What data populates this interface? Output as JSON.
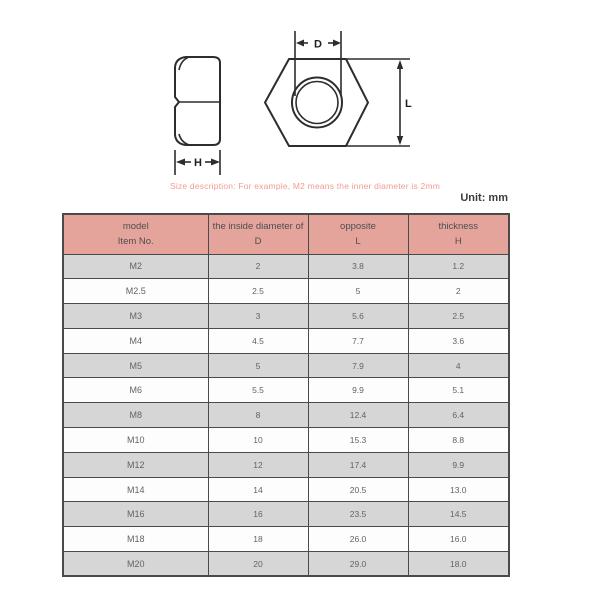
{
  "page": {
    "unit_label": "Unit: mm",
    "description": "Size description: For example, M2 means the inner diameter is 2mm"
  },
  "diagram": {
    "labels": {
      "d_label": "D",
      "l_label": "L",
      "h_label": "H"
    }
  },
  "colors": {
    "header_bg": "#e5a49b",
    "header_text": "#4e4e4e",
    "row_bg": "#fdfdfd",
    "row_alt_bg": "#d6d6d6",
    "border": "#4a4a4a",
    "table_text": "#636363",
    "description_text": "#f19b94",
    "unit_text": "#3d3d3d",
    "line": "#2d2d2d"
  },
  "table": {
    "header": {
      "col1_line1": "model",
      "col1_line2": "Item No.",
      "col2_line1": "the inside diameter of",
      "col2_line2": "D",
      "col3_line1": "opposite",
      "col3_line2": "L",
      "col4_line1": "thickness",
      "col4_line2": "H"
    },
    "rows": [
      {
        "model": "M2",
        "d": "2",
        "l": "3.8",
        "h": "1.2"
      },
      {
        "model": "M2.5",
        "d": "2.5",
        "l": "5",
        "h": "2"
      },
      {
        "model": "M3",
        "d": "3",
        "l": "5.6",
        "h": "2.5"
      },
      {
        "model": "M4",
        "d": "4.5",
        "l": "7.7",
        "h": "3.6"
      },
      {
        "model": "M5",
        "d": "5",
        "l": "7.9",
        "h": "4"
      },
      {
        "model": "M6",
        "d": "5.5",
        "l": "9.9",
        "h": "5.1"
      },
      {
        "model": "M8",
        "d": "8",
        "l": "12.4",
        "h": "6.4"
      },
      {
        "model": "M10",
        "d": "10",
        "l": "15.3",
        "h": "8.8"
      },
      {
        "model": "M12",
        "d": "12",
        "l": "17.4",
        "h": "9.9"
      },
      {
        "model": "M14",
        "d": "14",
        "l": "20.5",
        "h": "13.0"
      },
      {
        "model": "M16",
        "d": "16",
        "l": "23.5",
        "h": "14.5"
      },
      {
        "model": "M18",
        "d": "18",
        "l": "26.0",
        "h": "16.0"
      },
      {
        "model": "M20",
        "d": "20",
        "l": "29.0",
        "h": "18.0"
      }
    ]
  },
  "chart_data": {
    "type": "table",
    "title": "Hex nut dimension specifications",
    "unit": "mm",
    "columns": [
      "model / Item No.",
      "the inside diameter of D",
      "opposite L",
      "thickness H"
    ],
    "rows": [
      [
        "M2",
        2,
        3.8,
        1.2
      ],
      [
        "M2.5",
        2.5,
        5,
        2
      ],
      [
        "M3",
        3,
        5.6,
        2.5
      ],
      [
        "M4",
        4.5,
        7.7,
        3.6
      ],
      [
        "M5",
        5,
        7.9,
        4
      ],
      [
        "M6",
        5.5,
        9.9,
        5.1
      ],
      [
        "M8",
        8,
        12.4,
        6.4
      ],
      [
        "M10",
        10,
        15.3,
        8.8
      ],
      [
        "M12",
        12,
        17.4,
        9.9
      ],
      [
        "M14",
        14,
        20.5,
        13.0
      ],
      [
        "M16",
        16,
        23.5,
        14.5
      ],
      [
        "M18",
        18,
        26.0,
        16.0
      ],
      [
        "M20",
        20,
        29.0,
        18.0
      ]
    ]
  }
}
